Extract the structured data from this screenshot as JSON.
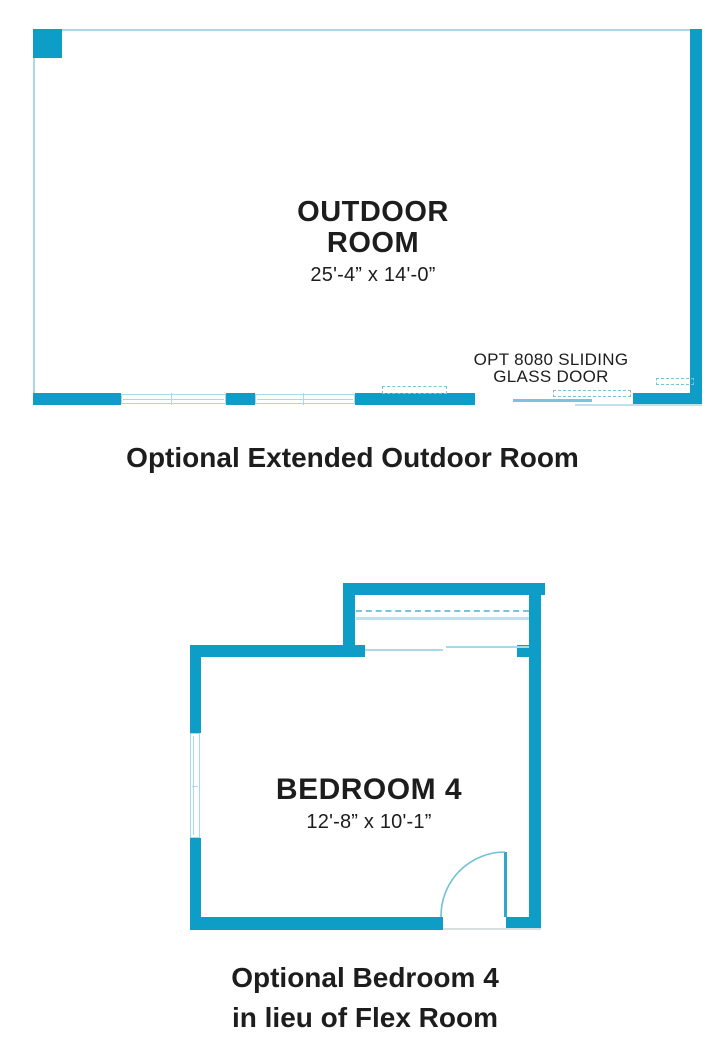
{
  "palette": {
    "wall_teal": "#0e9dc7",
    "line_light_blue": "#a9d8e8",
    "line_dashed_blue": "#7ac3db",
    "line_pale_blue": "#bfe0ec",
    "door_arc_blue": "#6fc0da",
    "text_black": "#1d1d1d"
  },
  "outdoor_room_plan": {
    "title_line1": "OUTDOOR",
    "title_line2": "ROOM",
    "dimensions": "25'-4” x 14'-0”",
    "door_label_line1": "OPT 8080 SLIDING",
    "door_label_line2": "GLASS DOOR",
    "caption": "Optional Extended Outdoor Room"
  },
  "bedroom_plan": {
    "title": "BEDROOM 4",
    "dimensions": "12'-8” x 10'-1”",
    "caption_line1": "Optional Bedroom 4",
    "caption_line2": "in lieu of Flex Room"
  }
}
